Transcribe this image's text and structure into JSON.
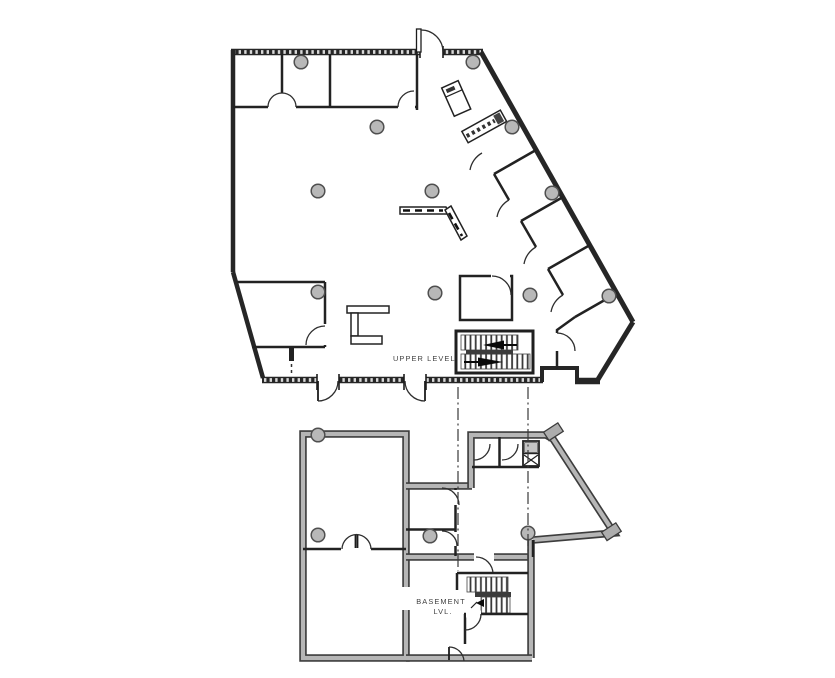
{
  "document": {
    "type": "architectural-floor-plan",
    "background": "#ffffff",
    "levels": [
      "upper level",
      "basement level"
    ]
  },
  "labels": {
    "upper_level": "UPPER LEVEL",
    "basement_line1": "BASEMENT",
    "basement_line2": "LVL."
  },
  "colors": {
    "exterior_wall": "#262626",
    "interior_wall": "#222222",
    "wall_hatch_tick": "#d8d8d8",
    "basement_wall_fill": "#b6b6b6",
    "basement_wall_edge": "#3d3d3d",
    "column_fill": "#b8b8b8",
    "column_stroke": "#4f4f4f",
    "stair_tread": "#3a3a3a",
    "stair_arrow": "#0a0a0a",
    "match_line": "#3a3a3a",
    "label_text": "#3f3f3f"
  },
  "icons": {
    "stair_up_arrow": "solid left-pointing arrow",
    "stair_down_arrow": "solid right-pointing arrow",
    "elevator_shaft": "box with X cross",
    "column_marker": "gray filled circle",
    "door_swing": "quarter-circle arc",
    "match_line": "vertical dash-dot alignment line"
  }
}
